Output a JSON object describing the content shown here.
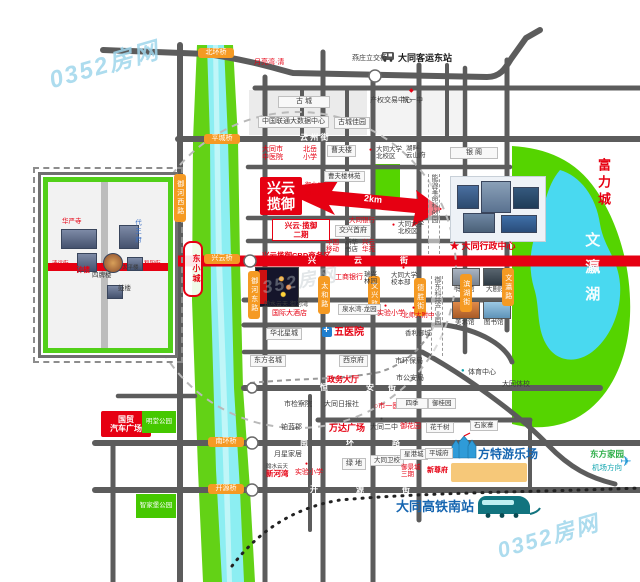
{
  "palette": {
    "road": "#5c5c5c",
    "main_red": "#e60012",
    "river_green": "#63d216",
    "water": "#8ceef2",
    "park": "#55d400",
    "lake": "#49d9f0",
    "orange_tag": "#f59a23",
    "brand_blue": "#1565b0"
  },
  "map": {
    "labels": [
      {
        "t": "0352房网",
        "x": 48,
        "y": 52,
        "k": "wm",
        "fs": 24,
        "n": "watermark"
      },
      {
        "t": "0352房网",
        "x": 250,
        "y": 272,
        "k": "wm2",
        "fs": 18,
        "n": "watermark-center"
      },
      {
        "t": "0352房网",
        "x": 496,
        "y": 524,
        "k": "wm",
        "fs": 22,
        "n": "watermark-bottom"
      },
      {
        "t": "燕庄立交桥",
        "x": 352,
        "y": 55,
        "k": "b",
        "fs": 7
      },
      {
        "t": "大同客运东站",
        "x": 398,
        "y": 53,
        "k": "bb",
        "fs": 9,
        "n": "bus-station-label"
      },
      {
        "t": "月亮湾·清",
        "x": 254,
        "y": 59,
        "k": "r",
        "fs": 7
      },
      {
        "t": "古  城",
        "x": 278,
        "y": 96,
        "k": "box",
        "fs": 7,
        "w": 44
      },
      {
        "t": "产权交易中心",
        "x": 370,
        "y": 97,
        "k": "b",
        "fs": 7
      },
      {
        "t": "◆",
        "x": 409,
        "y": 88,
        "k": "r",
        "fs": 6,
        "n": "school-icon"
      },
      {
        "t": "铁一中",
        "x": 402,
        "y": 97,
        "k": "b",
        "fs": 7
      },
      {
        "t": "中国联通大数据中心",
        "x": 258,
        "y": 116,
        "k": "box",
        "fs": 7
      },
      {
        "t": "古城佳园",
        "x": 334,
        "y": 117,
        "k": "box",
        "fs": 7
      },
      {
        "t": "云  州  街",
        "x": 300,
        "y": 133,
        "k": "wt",
        "fs": 8,
        "n": "road-name-yunzhou"
      },
      {
        "t": "大同市\n中医院",
        "x": 262,
        "y": 146,
        "k": "r",
        "fs": 7
      },
      {
        "t": "北岳\n小学",
        "x": 303,
        "y": 146,
        "k": "r",
        "fs": 7
      },
      {
        "t": "曹夫楼",
        "x": 327,
        "y": 145,
        "k": "box",
        "fs": 7
      },
      {
        "t": "●",
        "x": 369,
        "y": 148,
        "k": "r",
        "fs": 5,
        "n": "poi-dot-icon"
      },
      {
        "t": "大同大学\n北校区",
        "x": 376,
        "y": 146,
        "k": "b",
        "fs": 6.5
      },
      {
        "t": "湖畔·\n云山府",
        "x": 406,
        "y": 145,
        "k": "b",
        "fs": 6.5
      },
      {
        "t": "银  阁",
        "x": 450,
        "y": 147,
        "k": "box",
        "fs": 7,
        "w": 40
      },
      {
        "t": "富力城",
        "x": 595,
        "y": 158,
        "k": "rb",
        "v": 1,
        "fs": 13,
        "ls": 4
      },
      {
        "t": "文瀛湖",
        "x": 583,
        "y": 232,
        "k": "lake",
        "v": 1,
        "fs": 15,
        "ls": 12,
        "n": "lake-label"
      },
      {
        "t": "能源革命科创园",
        "x": 428,
        "y": 174,
        "k": "dashv",
        "fs": 7,
        "h": 80
      },
      {
        "t": "御东科技产业园",
        "x": 431,
        "y": 276,
        "k": "dashv",
        "fs": 7,
        "h": 80
      },
      {
        "t": "★ 大同行政中心",
        "x": 450,
        "y": 241,
        "k": "rb",
        "fs": 9,
        "n": "admin-center-label"
      },
      {
        "t": "博物馆",
        "x": 455,
        "y": 286,
        "k": "b",
        "fs": 6.5
      },
      {
        "t": "大剧院",
        "x": 486,
        "y": 286,
        "k": "b",
        "fs": 6.5
      },
      {
        "t": "美术馆",
        "x": 455,
        "y": 319,
        "k": "b",
        "fs": 6.5
      },
      {
        "t": "图书馆",
        "x": 484,
        "y": 319,
        "k": "b",
        "fs": 6.5
      },
      {
        "t": "●",
        "x": 461,
        "y": 368,
        "k": "teal",
        "fs": 6,
        "n": "sport-icon"
      },
      {
        "t": "体育中心",
        "x": 468,
        "y": 369,
        "k": "b",
        "fs": 7
      },
      {
        "t": "大同体校",
        "x": 502,
        "y": 381,
        "k": "b",
        "fs": 7
      },
      {
        "t": "市环保局",
        "x": 395,
        "y": 358,
        "k": "b",
        "fs": 7
      },
      {
        "t": "市公安局",
        "x": 396,
        "y": 375,
        "k": "b",
        "fs": 7
      },
      {
        "t": "香利御城",
        "x": 405,
        "y": 330,
        "k": "b",
        "fs": 6.5
      },
      {
        "t": "御河西路",
        "x": 174,
        "y": 174,
        "k": "o",
        "v": 1,
        "h": 46,
        "n": "road-tag"
      },
      {
        "t": "御河东路",
        "x": 248,
        "y": 271,
        "k": "o",
        "v": 1,
        "h": 46,
        "n": "road-tag"
      },
      {
        "t": "太和路",
        "x": 318,
        "y": 276,
        "k": "o",
        "v": 1,
        "h": 36,
        "n": "road-tag"
      },
      {
        "t": "文兴路",
        "x": 368,
        "y": 276,
        "k": "o",
        "v": 1,
        "h": 36,
        "n": "road-tag"
      },
      {
        "t": "德胜街",
        "x": 414,
        "y": 278,
        "k": "o",
        "v": 1,
        "h": 36,
        "n": "road-tag"
      },
      {
        "t": "滨湖街",
        "x": 460,
        "y": 274,
        "k": "o",
        "v": 1,
        "h": 36,
        "n": "road-tag"
      },
      {
        "t": "文瀛路",
        "x": 502,
        "y": 268,
        "k": "o",
        "v": 1,
        "h": 36,
        "n": "road-tag"
      },
      {
        "t": "北环桥",
        "x": 198,
        "y": 48,
        "k": "o",
        "w": 32,
        "n": "bridge-tag"
      },
      {
        "t": "平城桥",
        "x": 204,
        "y": 134,
        "k": "o",
        "w": 32,
        "n": "bridge-tag"
      },
      {
        "t": "兴云桥",
        "x": 204,
        "y": 254,
        "k": "o",
        "w": 32,
        "n": "bridge-tag"
      },
      {
        "t": "南环桥",
        "x": 208,
        "y": 437,
        "k": "o",
        "w": 32,
        "n": "bridge-tag"
      },
      {
        "t": "开源桥",
        "x": 208,
        "y": 484,
        "k": "o",
        "w": 32,
        "n": "bridge-tag"
      },
      {
        "t": "兴云\n揽御",
        "x": 260,
        "y": 177,
        "k": "blockred",
        "w": 42,
        "h": 38,
        "fs": 14,
        "n": "project-block"
      },
      {
        "t": "御水公元",
        "x": 305,
        "y": 183,
        "k": "r",
        "fs": 6
      },
      {
        "t": "御河苑",
        "x": 305,
        "y": 192,
        "k": "r",
        "fs": 6
      },
      {
        "t": "兴云·揽御\n二期",
        "x": 272,
        "y": 219,
        "k": "rbox",
        "w": 52,
        "fs": 7.5,
        "n": "project-phase2"
      },
      {
        "t": "兴云揽御CBD商务区",
        "x": 262,
        "y": 252,
        "k": "rb",
        "fs": 7.5,
        "n": "project-cbd"
      },
      {
        "t": "曹夫楼林苑",
        "x": 324,
        "y": 171,
        "k": "box",
        "fs": 6.5
      },
      {
        "t": "2km",
        "x": 364,
        "y": 194,
        "k": "arr",
        "fs": 9,
        "n": "distance-label"
      },
      {
        "t": "大同银行",
        "x": 349,
        "y": 217,
        "k": "r",
        "fs": 6.5
      },
      {
        "t": "交兴首府",
        "x": 335,
        "y": 225,
        "k": "box",
        "fs": 7
      },
      {
        "t": "中国\n移动",
        "x": 326,
        "y": 239,
        "k": "r",
        "fs": 6.5
      },
      {
        "t": "新华\n书店",
        "x": 345,
        "y": 239,
        "k": "b",
        "fs": 6.5
      },
      {
        "t": "兴云\n华苑",
        "x": 362,
        "y": 239,
        "k": "r",
        "fs": 6.5
      },
      {
        "t": "●",
        "x": 392,
        "y": 223,
        "k": "r",
        "fs": 5,
        "n": "poi-dot-icon"
      },
      {
        "t": "大同大学\n北校区",
        "x": 398,
        "y": 221,
        "k": "b",
        "fs": 6.5
      },
      {
        "t": "瑞兴\n林园",
        "x": 364,
        "y": 271,
        "k": "b",
        "fs": 6.5
      },
      {
        "t": "●",
        "x": 402,
        "y": 266,
        "k": "r",
        "fs": 5,
        "n": "poi-dot-icon"
      },
      {
        "t": "大同大学\n校本部",
        "x": 391,
        "y": 272,
        "k": "b",
        "fs": 6.5
      },
      {
        "t": "工商银行",
        "x": 335,
        "y": 274,
        "k": "r",
        "fs": 7
      },
      {
        "t": "翰水云天·御河湾",
        "x": 264,
        "y": 302,
        "k": "b",
        "fs": 6
      },
      {
        "t": "国际大酒店",
        "x": 272,
        "y": 310,
        "k": "r",
        "fs": 7
      },
      {
        "t": "泉水湾·龙园",
        "x": 338,
        "y": 304,
        "k": "box",
        "fs": 6.5
      },
      {
        "t": "●",
        "x": 384,
        "y": 304,
        "k": "r",
        "fs": 5,
        "n": "poi-dot-icon"
      },
      {
        "t": "实验小学",
        "x": 377,
        "y": 310,
        "k": "r",
        "fs": 7
      },
      {
        "t": "●",
        "x": 412,
        "y": 306,
        "k": "r",
        "fs": 5,
        "n": "poi-dot-icon"
      },
      {
        "t": "北师大附中",
        "x": 402,
        "y": 312,
        "k": "r",
        "fs": 6.5
      },
      {
        "t": "五医院",
        "x": 334,
        "y": 327,
        "k": "rb",
        "fs": 10
      },
      {
        "t": "华北星城",
        "x": 266,
        "y": 328,
        "k": "box",
        "fs": 7
      },
      {
        "t": "东方名城",
        "x": 250,
        "y": 355,
        "k": "box",
        "fs": 7
      },
      {
        "t": "西京府",
        "x": 339,
        "y": 355,
        "k": "box",
        "fs": 7
      },
      {
        "t": "政务大厅",
        "x": 327,
        "y": 375,
        "k": "rb",
        "fs": 8
      },
      {
        "t": "市检察院",
        "x": 284,
        "y": 401,
        "k": "b",
        "fs": 7
      },
      {
        "t": "铂蓝郡",
        "x": 281,
        "y": 424,
        "k": "b",
        "fs": 7
      },
      {
        "t": "月星家居",
        "x": 274,
        "y": 451,
        "k": "b",
        "fs": 7
      },
      {
        "t": "翰水云天",
        "x": 266,
        "y": 464,
        "k": "b",
        "fs": 5.5
      },
      {
        "t": "新河湾",
        "x": 266,
        "y": 470,
        "k": "rb",
        "fs": 7.5
      },
      {
        "t": "●",
        "x": 305,
        "y": 462,
        "k": "r",
        "fs": 5,
        "n": "poi-dot-icon"
      },
      {
        "t": "实验小学",
        "x": 295,
        "y": 469,
        "k": "r",
        "fs": 7
      },
      {
        "t": "国贸\n汽车广场",
        "x": 101,
        "y": 411,
        "k": "blockred",
        "w": 50,
        "h": 26,
        "fs": 8
      },
      {
        "t": "明堂公园",
        "x": 142,
        "y": 411,
        "k": "blockgreen",
        "w": 34,
        "h": 22,
        "fs": 6.5
      },
      {
        "t": "智家堡公园",
        "x": 136,
        "y": 494,
        "k": "blockgreen",
        "w": 40,
        "h": 24,
        "fs": 6.5
      },
      {
        "t": "大同日报社",
        "x": 324,
        "y": 401,
        "k": "b",
        "fs": 7
      },
      {
        "t": "○市一医院",
        "x": 374,
        "y": 403,
        "k": "r",
        "fs": 7
      },
      {
        "t": "四季",
        "x": 396,
        "y": 398,
        "k": "box",
        "fs": 6.5,
        "w": 24
      },
      {
        "t": "御桂园",
        "x": 428,
        "y": 398,
        "k": "box",
        "fs": 6.5
      },
      {
        "t": "万达广场",
        "x": 329,
        "y": 423,
        "k": "rb",
        "fs": 9
      },
      {
        "t": "●",
        "x": 380,
        "y": 417,
        "k": "b",
        "fs": 5,
        "n": "poi-dot-icon"
      },
      {
        "t": "大同二中",
        "x": 370,
        "y": 424,
        "k": "b",
        "fs": 7
      },
      {
        "t": "御花园",
        "x": 400,
        "y": 423,
        "k": "r",
        "fs": 7
      },
      {
        "t": "花千树",
        "x": 426,
        "y": 422,
        "k": "box",
        "fs": 6.5
      },
      {
        "t": "石家寨",
        "x": 470,
        "y": 420,
        "k": "box",
        "fs": 6.5
      },
      {
        "t": "绿 地",
        "x": 342,
        "y": 458,
        "k": "box",
        "fs": 7
      },
      {
        "t": "大同卫校",
        "x": 370,
        "y": 455,
        "k": "box",
        "fs": 6.5
      },
      {
        "t": "星港城",
        "x": 400,
        "y": 449,
        "k": "box",
        "fs": 6.5
      },
      {
        "t": "御景城\n三期",
        "x": 401,
        "y": 464,
        "k": "r",
        "fs": 6.5
      },
      {
        "t": "平城府",
        "x": 425,
        "y": 448,
        "k": "box",
        "fs": 6.5
      },
      {
        "t": "新尊府",
        "x": 427,
        "y": 467,
        "k": "rb",
        "fs": 7
      },
      {
        "t": "方特游乐场",
        "x": 478,
        "y": 448,
        "k": "blue",
        "fs": 12,
        "n": "fantawild-label"
      },
      {
        "t": "东方家园",
        "x": 590,
        "y": 450,
        "k": "grn",
        "fs": 8.5
      },
      {
        "t": "机场方向",
        "x": 592,
        "y": 464,
        "k": "teal",
        "fs": 7.5
      },
      {
        "t": "✈",
        "x": 620,
        "y": 453,
        "k": "plane",
        "fs": 14,
        "n": "plane-icon"
      },
      {
        "t": "大同高铁南站",
        "x": 396,
        "y": 500,
        "k": "blue",
        "fs": 13,
        "n": "hsr-station-label"
      },
      {
        "t": "兴",
        "x": 308,
        "y": 256,
        "k": "wt"
      },
      {
        "t": "云",
        "x": 354,
        "y": 256,
        "k": "wt"
      },
      {
        "t": "街",
        "x": 400,
        "y": 256,
        "k": "wt"
      },
      {
        "t": "恒",
        "x": 320,
        "y": 383,
        "k": "wt"
      },
      {
        "t": "安",
        "x": 366,
        "y": 383,
        "k": "wt"
      },
      {
        "t": "街",
        "x": 388,
        "y": 383,
        "k": "wt"
      },
      {
        "t": "南",
        "x": 300,
        "y": 438,
        "k": "wt"
      },
      {
        "t": "环",
        "x": 346,
        "y": 438,
        "k": "wt"
      },
      {
        "t": "路",
        "x": 392,
        "y": 438,
        "k": "wt"
      },
      {
        "t": "开",
        "x": 310,
        "y": 485,
        "k": "wt"
      },
      {
        "t": "源",
        "x": 356,
        "y": 485,
        "k": "wt"
      },
      {
        "t": "街",
        "x": 402,
        "y": 485,
        "k": "wt"
      },
      {
        "t": "华严寺",
        "x": 62,
        "y": 218,
        "k": "r",
        "fs": 6.5
      },
      {
        "t": "代王府",
        "x": 133,
        "y": 219,
        "k": "bluev",
        "v": 1,
        "fs": 6.5
      },
      {
        "t": "钟楼",
        "x": 76,
        "y": 267,
        "k": "rb",
        "fs": 7
      },
      {
        "t": "四牌楼",
        "x": 92,
        "y": 272,
        "k": "b",
        "fs": 6.5
      },
      {
        "t": "太平楼",
        "x": 122,
        "y": 265,
        "k": "b",
        "fs": 5.5
      },
      {
        "t": "鼓楼",
        "x": 118,
        "y": 285,
        "k": "b",
        "fs": 6.5
      },
      {
        "t": "清远街",
        "x": 52,
        "y": 261,
        "k": "r",
        "fs": 5.5
      },
      {
        "t": "和阳街",
        "x": 144,
        "y": 261,
        "k": "r",
        "fs": 5.5
      },
      {
        "t": "东小城",
        "x": 183,
        "y": 241,
        "k": "redring",
        "v": 1,
        "h": 48,
        "fs": 8,
        "w": 16
      }
    ]
  }
}
